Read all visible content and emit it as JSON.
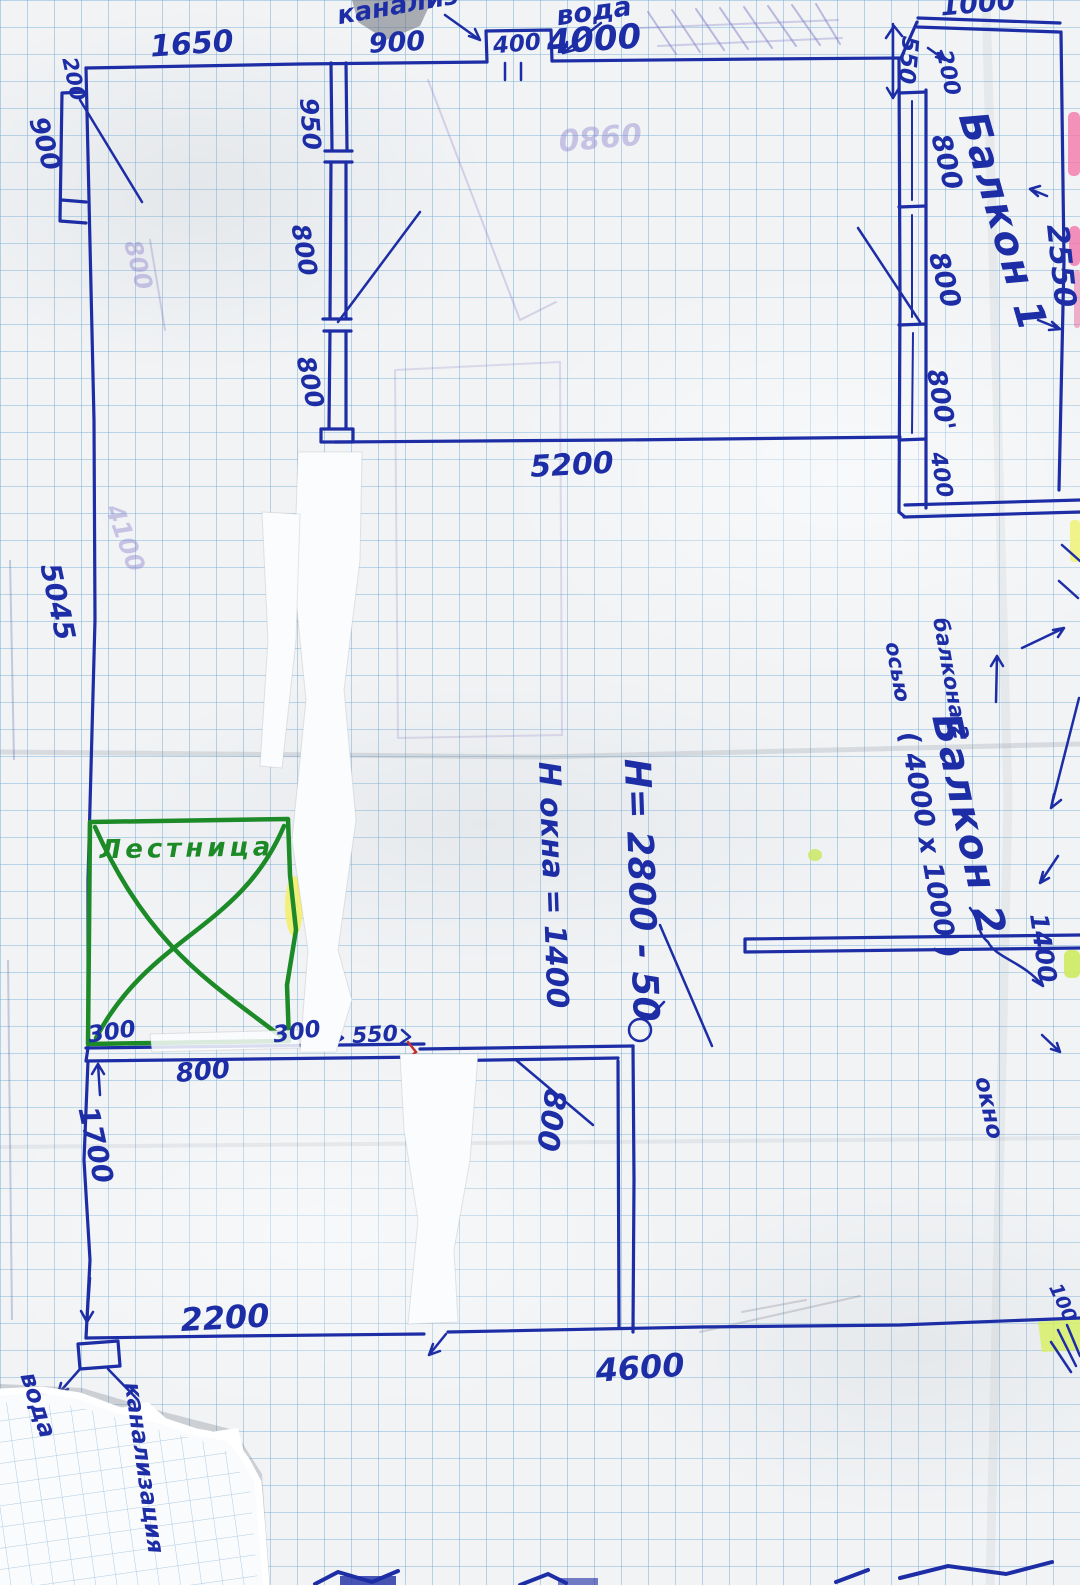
{
  "document": {
    "kind": "hand-drawn floor plan sketch on graph paper",
    "language": "Russian",
    "units": "millimetres"
  },
  "colors": {
    "pen": "#1d2da5",
    "green": "#1d8a28",
    "red": "#c43030",
    "ghost": "rgba(130,115,200,0.38)",
    "grid": "#76aed6",
    "paper": "#f1f3f5",
    "highlight_pink": "#f478aa",
    "highlight_yellow": "#eef082",
    "highlight_lime": "#cdeb5f"
  },
  "labels": [
    {
      "name": "plumb-note-top",
      "text": "канализ",
      "x": 398,
      "y": 6,
      "rot": -10,
      "size": 26
    },
    {
      "name": "dim-1650",
      "text": "1650",
      "x": 192,
      "y": 45,
      "rot": -4,
      "size": 30
    },
    {
      "name": "dim-900-top",
      "text": "900",
      "x": 397,
      "y": 43,
      "rot": -3,
      "size": 27
    },
    {
      "name": "dim-400-shaft",
      "text": "400",
      "x": 517,
      "y": 45,
      "rot": -5,
      "size": 23
    },
    {
      "name": "note-voda-top",
      "text": "вода",
      "x": 594,
      "y": 12,
      "rot": -8,
      "size": 27
    },
    {
      "name": "dim-4000",
      "text": "4000",
      "x": 594,
      "y": 40,
      "rot": -4,
      "size": 34
    },
    {
      "name": "dim-1000-balcony",
      "text": "1000",
      "x": 978,
      "y": 4,
      "rot": -5,
      "size": 27
    },
    {
      "name": "dim-550-balcony",
      "text": "550",
      "x": 907,
      "y": 60,
      "rot": 95,
      "size": 23
    },
    {
      "name": "dim-200-balcony",
      "text": "200",
      "x": 947,
      "y": 73,
      "rot": 78,
      "size": 22
    },
    {
      "name": "dim-800-balcony-1",
      "text": "800",
      "x": 946,
      "y": 162,
      "rot": 76,
      "size": 27
    },
    {
      "name": "dim-800-balcony-2",
      "text": "800",
      "x": 944,
      "y": 280,
      "rot": 75,
      "size": 27
    },
    {
      "name": "label-balcony-1",
      "text": "Балкон 1",
      "x": 1002,
      "y": 222,
      "rot": 74,
      "size": 40,
      "ls": 2
    },
    {
      "name": "dim-2550",
      "text": "2550",
      "x": 1060,
      "y": 266,
      "rot": 84,
      "size": 30
    },
    {
      "name": "dim-800-balcony-3",
      "text": "800'",
      "x": 940,
      "y": 400,
      "rot": 80,
      "size": 26
    },
    {
      "name": "dim-400-balcony",
      "text": "400",
      "x": 940,
      "y": 475,
      "rot": 80,
      "size": 22
    },
    {
      "name": "dim-5200",
      "text": "5200",
      "x": 572,
      "y": 466,
      "rot": -3,
      "size": 30
    },
    {
      "name": "dim-200-left",
      "text": "200",
      "x": 73,
      "y": 79,
      "rot": 78,
      "size": 21
    },
    {
      "name": "dim-900-left",
      "text": "900",
      "x": 44,
      "y": 144,
      "rot": 74,
      "size": 26
    },
    {
      "name": "dim-950",
      "text": "950",
      "x": 310,
      "y": 124,
      "rot": 86,
      "size": 25
    },
    {
      "name": "dim-800-int-1",
      "text": "800",
      "x": 304,
      "y": 250,
      "rot": 80,
      "size": 25
    },
    {
      "name": "dim-800-int-2",
      "text": "800",
      "x": 310,
      "y": 382,
      "rot": 78,
      "size": 25
    },
    {
      "name": "dim-5045",
      "text": "5045",
      "x": 57,
      "y": 602,
      "rot": 78,
      "size": 28
    },
    {
      "name": "ghost-4100",
      "text": "4100",
      "x": 125,
      "y": 538,
      "rot": 70,
      "size": 25,
      "color": "ghost"
    },
    {
      "name": "dim-h-total",
      "text": "H= 2800 - 50",
      "x": 640,
      "y": 890,
      "rot": 88,
      "size": 36
    },
    {
      "name": "dim-h-window",
      "text": "H окна = 1400",
      "x": 552,
      "y": 885,
      "rot": 88,
      "size": 30
    },
    {
      "name": "note-axis-osyu",
      "text": "осью",
      "x": 897,
      "y": 672,
      "rot": 80,
      "size": 21
    },
    {
      "name": "note-axis-balkona",
      "text": "балкона 2",
      "x": 950,
      "y": 679,
      "rot": 80,
      "size": 21
    },
    {
      "name": "label-balcony-2",
      "text": "Балкон 2",
      "x": 968,
      "y": 825,
      "rot": 78,
      "size": 40,
      "ls": 2
    },
    {
      "name": "dim-balcony-2-size",
      "text": "( 4000 х 1000 )",
      "x": 928,
      "y": 845,
      "rot": 80,
      "size": 27
    },
    {
      "name": "dim-1400-right",
      "text": "1400",
      "x": 1043,
      "y": 948,
      "rot": 82,
      "size": 25
    },
    {
      "name": "note-okno",
      "text": "окно",
      "x": 988,
      "y": 1108,
      "rot": 78,
      "size": 23
    },
    {
      "name": "dim-100",
      "text": "100",
      "x": 1062,
      "y": 1303,
      "rot": 65,
      "size": 19
    },
    {
      "name": "label-lestnitsa",
      "text": "Лестница",
      "x": 187,
      "y": 849,
      "rot": -1,
      "size": 26,
      "color": "green",
      "ls": 4
    },
    {
      "name": "dim-300-left",
      "text": "300",
      "x": 112,
      "y": 1033,
      "rot": -8,
      "size": 23
    },
    {
      "name": "dim-300-right",
      "text": "300",
      "x": 297,
      "y": 1033,
      "rot": -8,
      "size": 23
    },
    {
      "name": "dim-550-bottom",
      "text": "550",
      "x": 375,
      "y": 1036,
      "rot": -3,
      "size": 22
    },
    {
      "name": "dim-800-stairs",
      "text": "800",
      "x": 203,
      "y": 1072,
      "rot": -5,
      "size": 26
    },
    {
      "name": "dim-1700",
      "text": "1700",
      "x": 95,
      "y": 1145,
      "rot": 78,
      "size": 28
    },
    {
      "name": "dim-2200",
      "text": "2200",
      "x": 225,
      "y": 1318,
      "rot": -3,
      "size": 32
    },
    {
      "name": "dim-4600",
      "text": "4600",
      "x": 640,
      "y": 1368,
      "rot": -4,
      "size": 32
    },
    {
      "name": "dim-800-door",
      "text": "800",
      "x": 550,
      "y": 1120,
      "rot": 98,
      "size": 30,
      "weight": 700
    },
    {
      "name": "note-voda-bottom",
      "text": "вода",
      "x": 38,
      "y": 1405,
      "rot": 72,
      "size": 24
    },
    {
      "name": "note-kanalizatsiya",
      "text": "канализация",
      "x": 143,
      "y": 1468,
      "rot": 82,
      "size": 23
    },
    {
      "name": "ghost-0980",
      "text": "0980",
      "x": 600,
      "y": 135,
      "rot": 175,
      "size": 30,
      "color": "ghost"
    },
    {
      "name": "ghost-800-left",
      "text": "800",
      "x": 138,
      "y": 265,
      "rot": 75,
      "size": 24,
      "color": "ghost"
    }
  ]
}
